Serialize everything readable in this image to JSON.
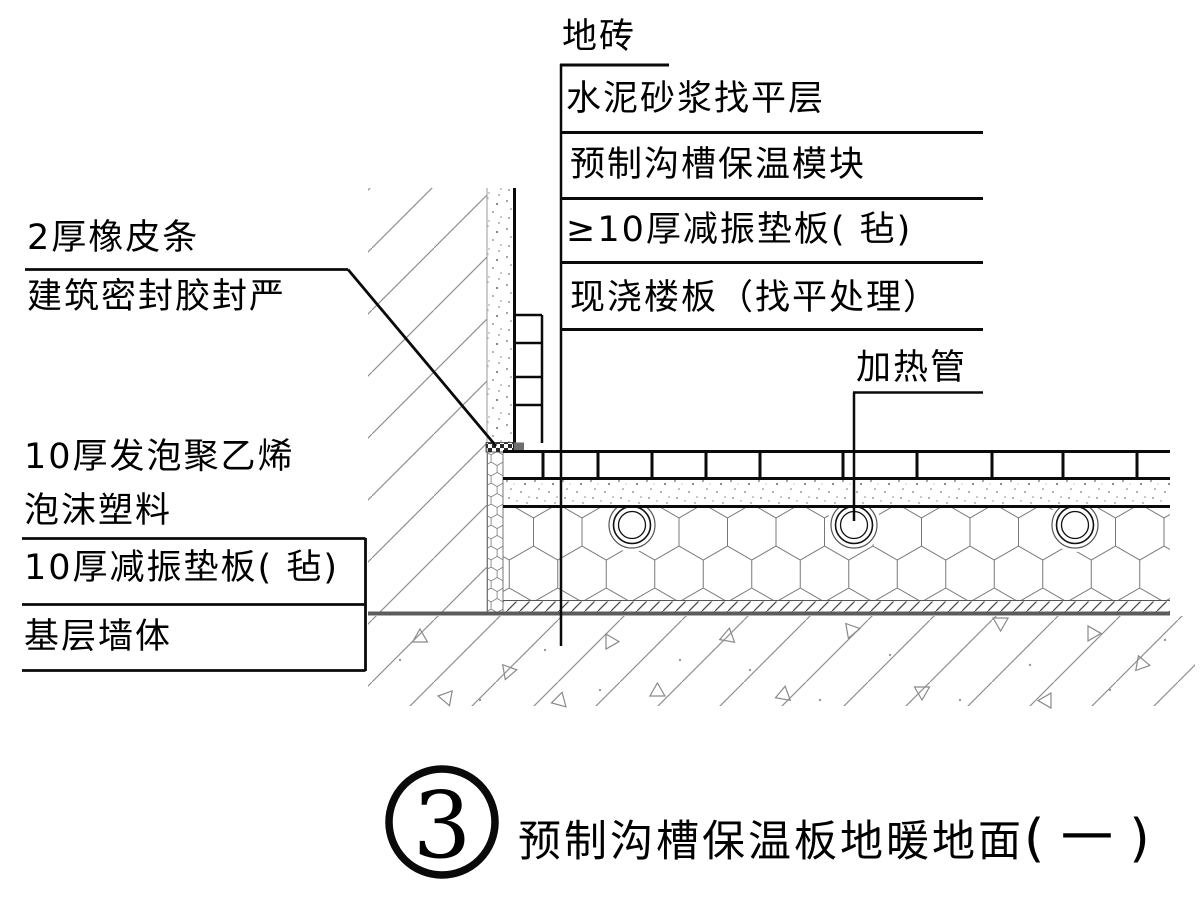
{
  "figure": {
    "number": "3",
    "title": "预制沟槽保温板地暖地面",
    "title_suffix": "( 一 )"
  },
  "callouts": {
    "floor_tile": "地砖",
    "screed": "水泥砂浆找平层",
    "insulation_module": "预制沟槽保温模块",
    "damping_pad_min10": "≥10厚减振垫板( 毡)",
    "slab": "现浇楼板（找平处理）",
    "heating_pipe": "加热管",
    "rubber_strip": "2厚橡皮条",
    "sealant": "建筑密封胶封严",
    "edge_foam_line1": "10厚发泡聚乙烯",
    "edge_foam_line2": "泡沫塑料",
    "damping_pad_10": "10厚减振垫板( 毡)",
    "base_wall": "基层墙体"
  },
  "colors": {
    "line": "#0a0a0a",
    "gray_line": "#5c5c5c",
    "hatch": "#8f8f8f"
  }
}
